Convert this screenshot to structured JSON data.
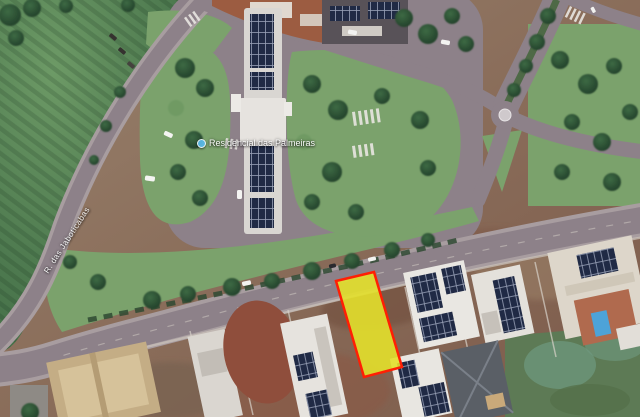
{
  "map": {
    "street_label": "R. das Jaboticabas",
    "poi": {
      "label": "Residencial das Palmeiras"
    }
  },
  "colors": {
    "lot-fill": "#e3e02b",
    "lot-stroke": "#ff1f04",
    "road": "#8d8189",
    "road-shoulder": "#a89da0",
    "field": "#4f7b50",
    "park": "#7ba26c",
    "dirt": "#8d7260",
    "tree": "#2b4d31",
    "panel": "#202a45",
    "label-text": "#ffffff",
    "pin": "#5ab8e6"
  }
}
